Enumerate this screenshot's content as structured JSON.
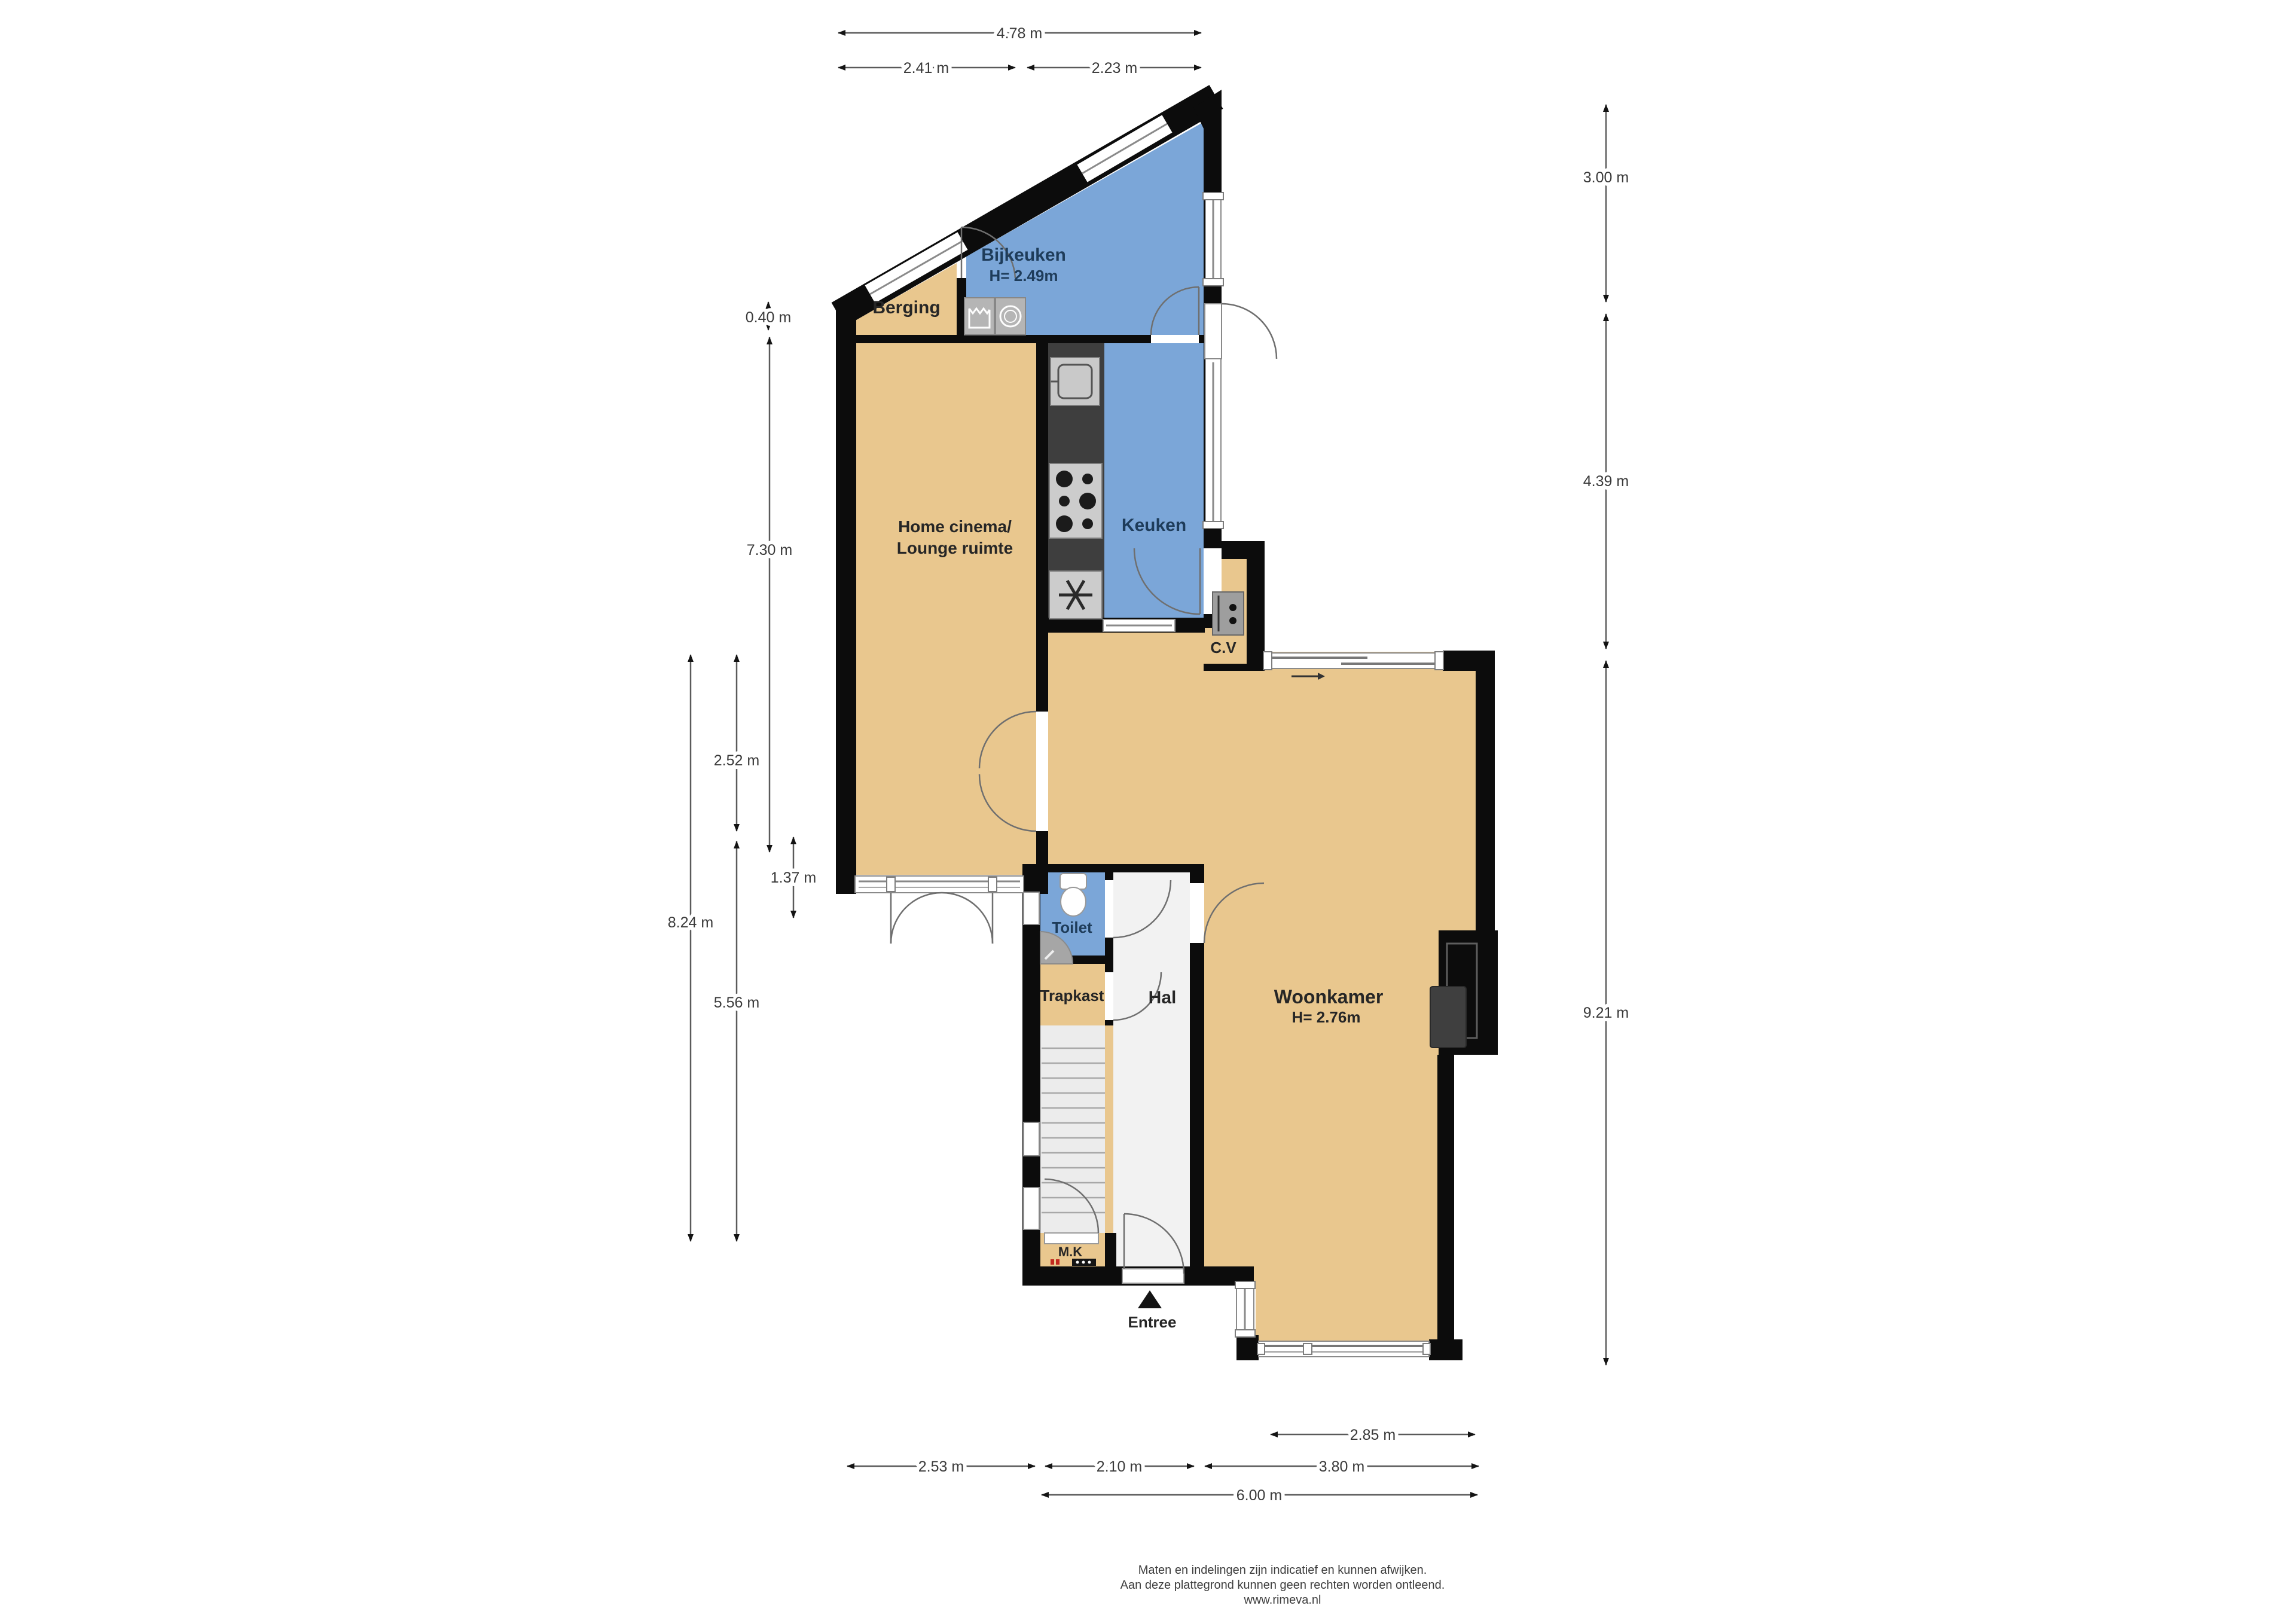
{
  "title": "Begane grond plattegrond (floor plan)",
  "rooms": {
    "berging": {
      "label": "Berging"
    },
    "bijkeuken": {
      "label": "Bijkeuken",
      "height": "H= 2.49m"
    },
    "home_cinema": {
      "label_line1": "Home cinema/",
      "label_line2": "Lounge ruimte"
    },
    "keuken": {
      "label": "Keuken"
    },
    "cv": {
      "label": "C.V"
    },
    "woonkamer": {
      "label": "Woonkamer",
      "height": "H= 2.76m"
    },
    "toilet": {
      "label": "Toilet"
    },
    "trapkast": {
      "label": "Trapkast"
    },
    "hal": {
      "label": "Hal"
    },
    "mk": {
      "label": "M.K"
    },
    "entree": {
      "label": "Entree"
    }
  },
  "dimensions": {
    "top": [
      {
        "label": "4.78 m"
      },
      {
        "label": "2.41 m"
      },
      {
        "label": "2.23 m"
      }
    ],
    "left": [
      {
        "label": "0.40 m"
      },
      {
        "label": "7.30 m"
      },
      {
        "label": "2.52 m"
      },
      {
        "label": "1.37 m"
      },
      {
        "label": "8.24 m"
      },
      {
        "label": "5.56 m"
      }
    ],
    "right": [
      {
        "label": "3.00 m"
      },
      {
        "label": "4.39 m"
      },
      {
        "label": "9.21 m"
      }
    ],
    "bottom": [
      {
        "label": "2.85 m"
      },
      {
        "label": "2.53 m"
      },
      {
        "label": "2.10 m"
      },
      {
        "label": "3.80 m"
      },
      {
        "label": "6.00 m"
      }
    ]
  },
  "footer": {
    "line1": "Maten en indelingen zijn indicatief en kunnen afwijken.",
    "line2": "Aan deze plattegrond kunnen geen rechten worden ontleend.",
    "line3": "www.rimeva.nl"
  },
  "icons": {
    "washer": "laundry-tub-icon",
    "dryer": "washing-machine-icon",
    "sink": "kitchen-sink-icon",
    "stove": "stove-burners-icon",
    "fan": "extractor-fan-icon",
    "boiler": "cv-boiler-icon",
    "wc": "toilet-bowl-icon",
    "basin": "corner-basin-icon",
    "panel": "electrical-panel-icon",
    "stairs": "staircase-icon",
    "entree_arrow": "entrance-arrow-icon",
    "slide_arrow": "sliding-door-arrow-icon"
  },
  "colors": {
    "wall": "#0c0c0c",
    "floor_tan": "#e9c78e",
    "floor_blue": "#7ba6d8",
    "floor_hal": "#f2f2f2",
    "floor_stairs": "#ececec",
    "counter": "#3e3e3e",
    "appliance_gray": "#b5b5b5",
    "label_dark": "#262626",
    "label_navy": "#1e3c5a",
    "dim_gray": "#3a3a3a",
    "red_mark": "#c22a1f"
  }
}
